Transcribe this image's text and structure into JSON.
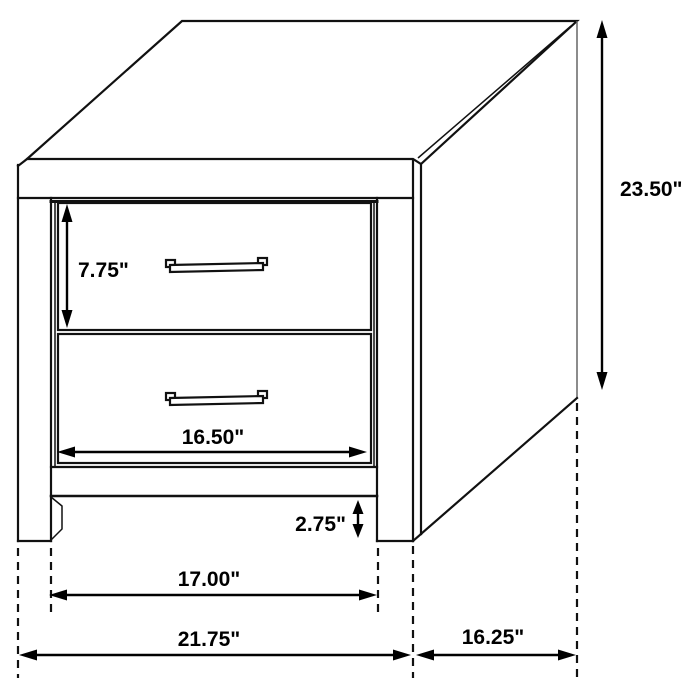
{
  "diagram": {
    "subject": "two-drawer-nightstand-dimension-drawing",
    "background_color": "#ffffff",
    "line_color": "#111111",
    "dimension_color": "#000000",
    "unit": "inches",
    "dimensions": {
      "drawer_height": {
        "label": "7.75\"",
        "value": 7.75,
        "measures": "top drawer front height"
      },
      "overall_height": {
        "label": "23.50\"",
        "value": 23.5,
        "measures": "overall height"
      },
      "drawer_width": {
        "label": "16.50\"",
        "value": 16.5,
        "measures": "drawer front width"
      },
      "base_clearance": {
        "label": "2.75\"",
        "value": 2.75,
        "measures": "floor to bottom rail clearance"
      },
      "inner_width": {
        "label": "17.00\"",
        "value": 17.0,
        "measures": "width between legs"
      },
      "overall_width": {
        "label": "21.75\"",
        "value": 21.75,
        "measures": "overall width"
      },
      "depth": {
        "label": "16.25\"",
        "value": 16.25,
        "measures": "overall depth"
      }
    },
    "parts": {
      "drawer_count": 2,
      "handle_count": 2
    }
  }
}
